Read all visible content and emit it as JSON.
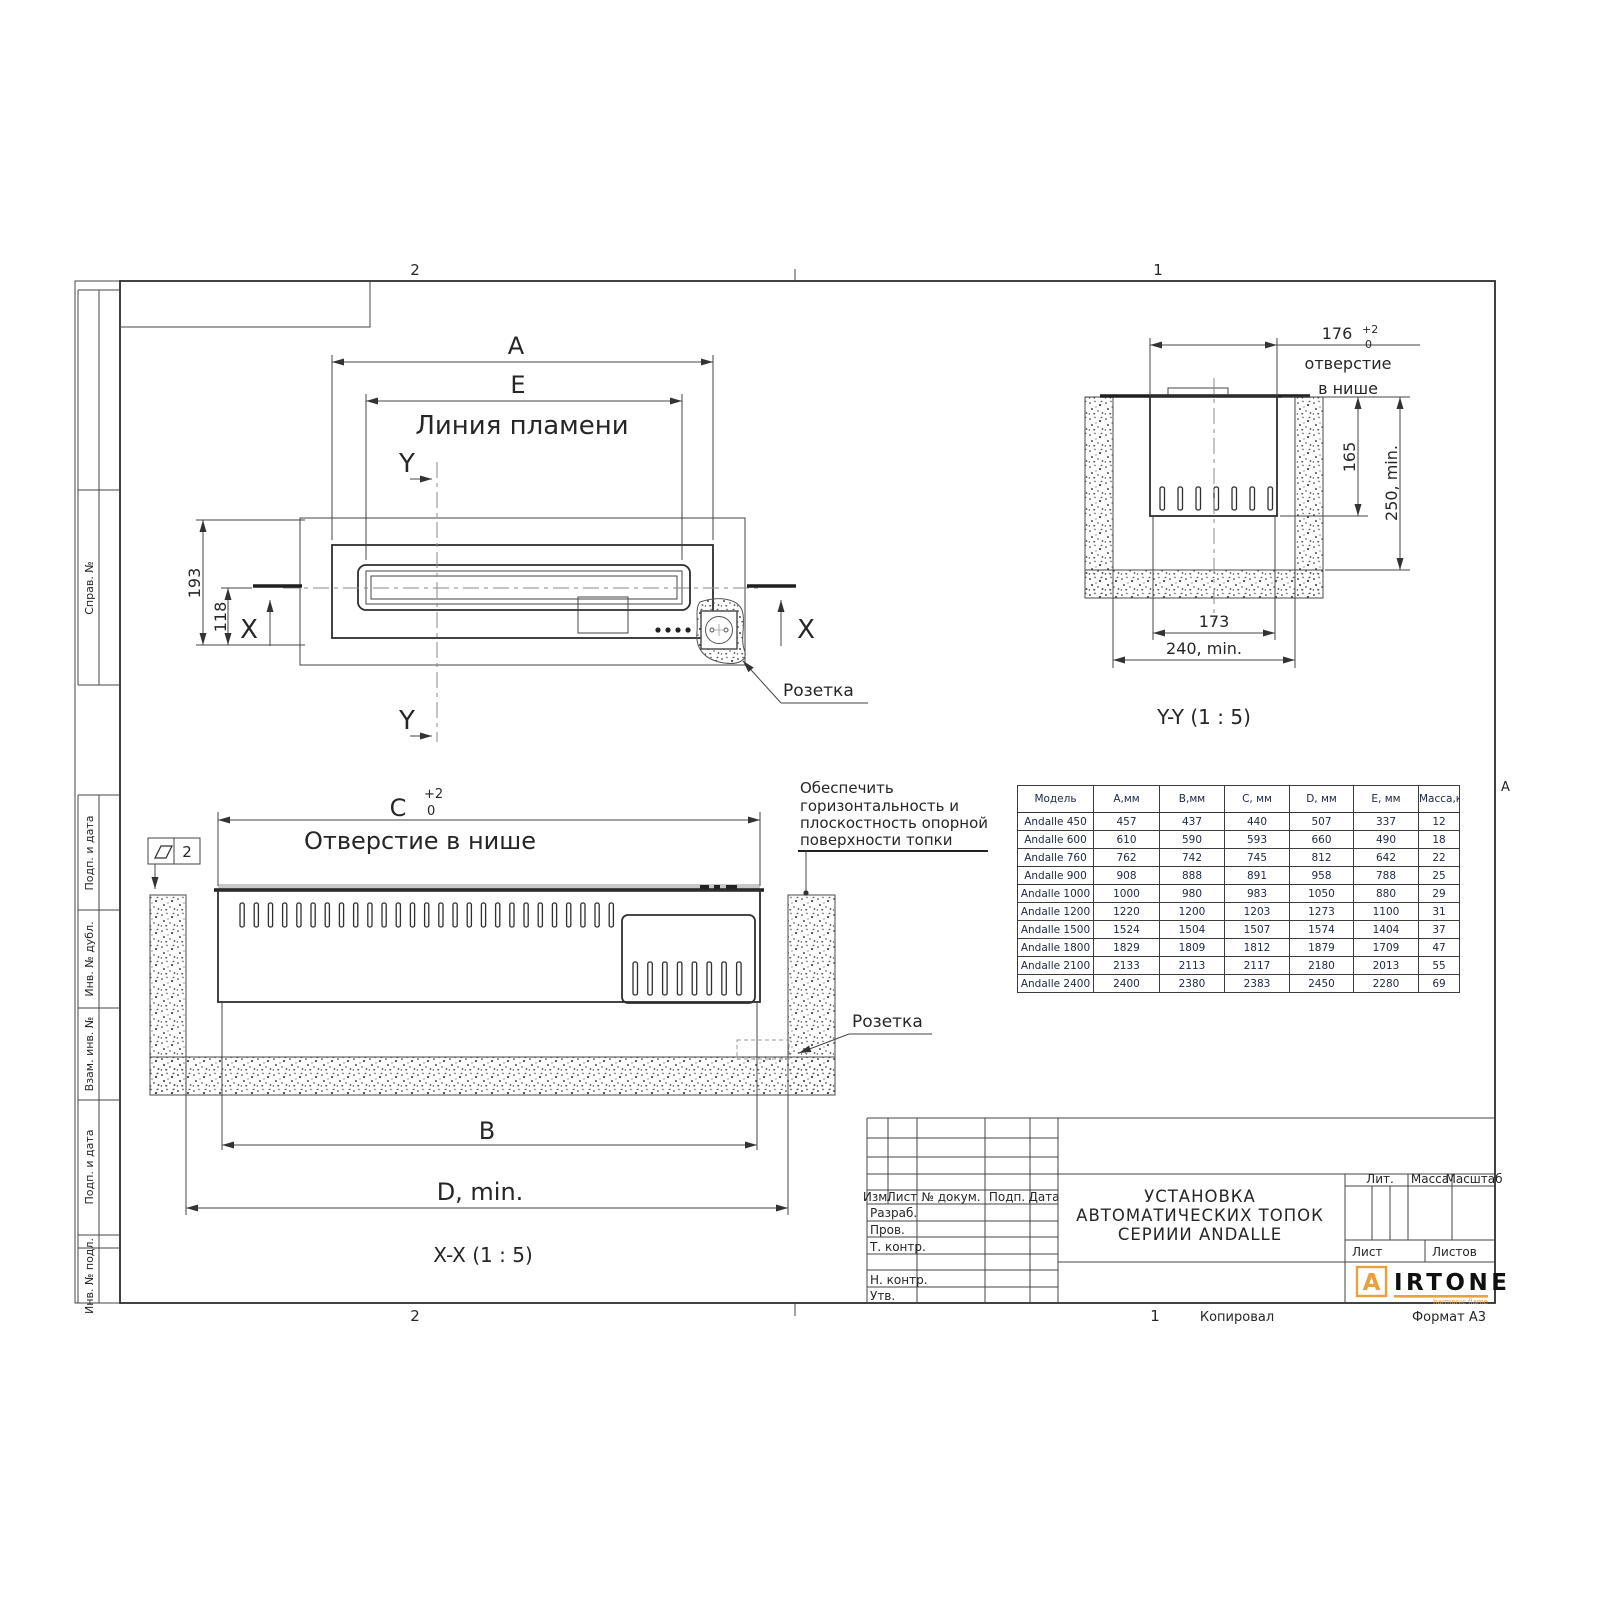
{
  "sheet": {
    "zone_top_left": "2",
    "zone_top_right": "1",
    "zone_bottom_left": "2",
    "zone_bottom_right": "1",
    "zone_letter_right": "А",
    "footer_copied": "Копировал",
    "footer_format": "Формат А3"
  },
  "side_labels": {
    "sprav": "Справ. №",
    "podp_data_1": "Подп. и дата",
    "inv_dubl": "Инв. № дубл.",
    "vzam_inv": "Взам. инв. №",
    "podp_data_2": "Подп. и дата",
    "inv_podl": "Инв. № подл."
  },
  "plan_view": {
    "dim_a": "A",
    "dim_e": "E",
    "flame_line_label": "Линия пламени",
    "dim_193": "193",
    "dim_118": "118",
    "section_x": "X",
    "section_y": "Y",
    "socket_label": "Розетка"
  },
  "section_yy": {
    "dim_176": "176",
    "tol_plus": "+2",
    "tol_zero": "0",
    "opening_line1": "отверстие",
    "opening_line2": "в нише",
    "dim_165": "165",
    "dim_250": "250, min.",
    "dim_173": "173",
    "dim_240": "240, min.",
    "caption": "Y-Y (1 : 5)"
  },
  "section_xx": {
    "dim_c": "C",
    "tol_plus": "+2",
    "tol_zero": "0",
    "opening_label": "Отверстие в нише",
    "flatness_value": "2",
    "dim_b": "B",
    "dim_d": "D, min.",
    "caption": "X-X (1 : 5)",
    "note_line1": "Обеспечить",
    "note_line2": "горизонтальность и",
    "note_line3": "плоскостность опорной",
    "note_line4": "поверхности топки",
    "socket_label": "Розетка"
  },
  "table": {
    "headers": [
      "Модель",
      "А,мм",
      "В,мм",
      "С, мм",
      "D, мм",
      "Е, мм",
      "Масса,кг"
    ],
    "rows": [
      [
        "Andalle 450",
        "457",
        "437",
        "440",
        "507",
        "337",
        "12"
      ],
      [
        "Andalle 600",
        "610",
        "590",
        "593",
        "660",
        "490",
        "18"
      ],
      [
        "Andalle 760",
        "762",
        "742",
        "745",
        "812",
        "642",
        "22"
      ],
      [
        "Andalle 900",
        "908",
        "888",
        "891",
        "958",
        "788",
        "25"
      ],
      [
        "Andalle 1000",
        "1000",
        "980",
        "983",
        "1050",
        "880",
        "29"
      ],
      [
        "Andalle 1200",
        "1220",
        "1200",
        "1203",
        "1273",
        "1100",
        "31"
      ],
      [
        "Andalle 1500",
        "1524",
        "1504",
        "1507",
        "1574",
        "1404",
        "37"
      ],
      [
        "Andalle 1800",
        "1829",
        "1809",
        "1812",
        "1879",
        "1709",
        "47"
      ],
      [
        "Andalle 2100",
        "2133",
        "2113",
        "2117",
        "2180",
        "2013",
        "55"
      ],
      [
        "Andalle 2400",
        "2400",
        "2380",
        "2383",
        "2450",
        "2280",
        "69"
      ]
    ]
  },
  "title_block": {
    "col_izm": "Изм.",
    "col_list": "Лист",
    "col_doc": "№ докум.",
    "col_podp": "Подп.",
    "col_data": "Дата",
    "roles": [
      "Разраб.",
      "Пров.",
      "Т. контр.",
      "",
      "Н. контр.",
      "Утв."
    ],
    "title_line1": "УСТАНОВКА",
    "title_line2": "АВТОМАТИЧЕСКИХ ТОПОК",
    "title_line3": "СЕРИИИ ANDALLE",
    "lit": "Лит.",
    "massa": "Масса",
    "masshtab": "Масштаб",
    "list": "Лист",
    "listov": "Листов",
    "logo_a": "A",
    "logo_rest": "IRTONE",
    "logo_tagline": "harmonic flame",
    "logo_color": "#E8A13C"
  }
}
